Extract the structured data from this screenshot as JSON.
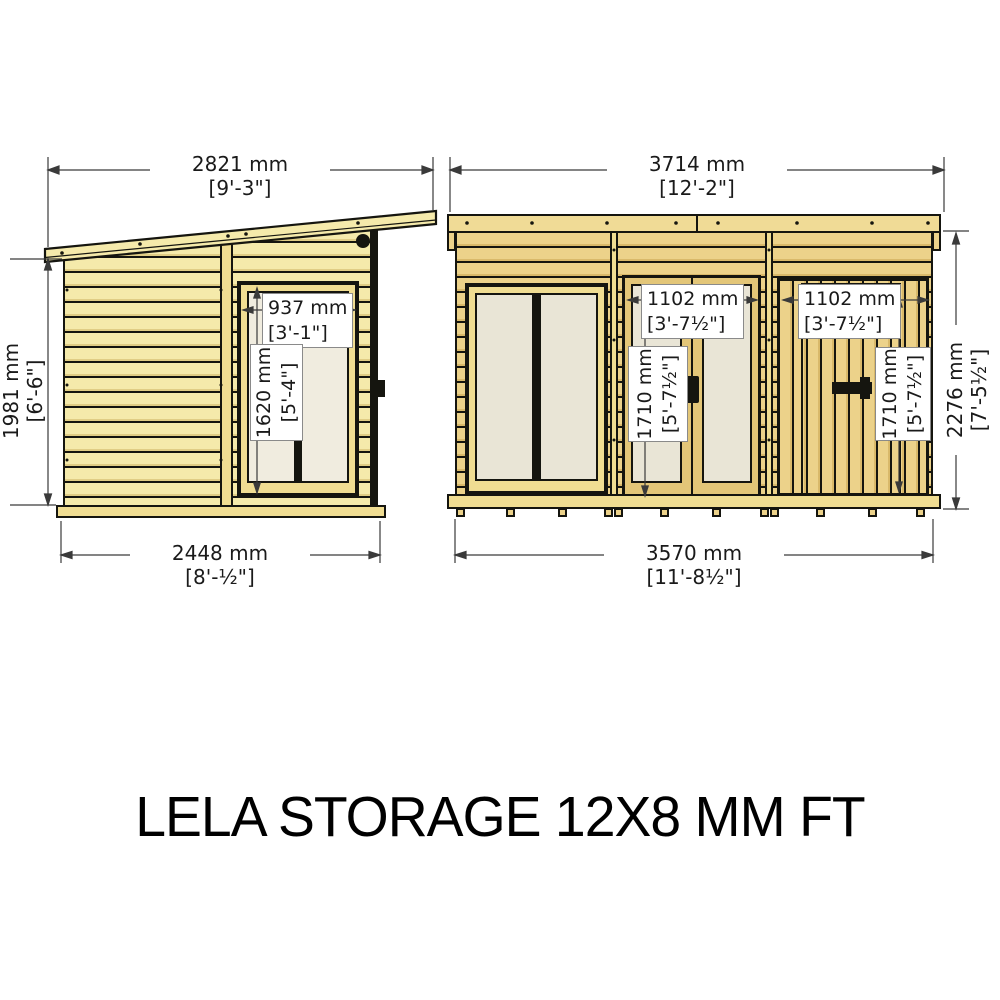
{
  "title": "LELA STORAGE 12X8 MM FT",
  "colors": {
    "outline": "#15150f",
    "wood_pale": "#f5eaab",
    "wood_pale_shade": "#e0cd85",
    "wood_gold": "#ecd28a",
    "wood_gold_shade": "#d9b96a",
    "wood_trim": "#f0dd92",
    "fascia": "#f0db96",
    "glazing": "#e9e5d6",
    "glazing_side": "#f0ecdf",
    "dim_line": "#3a3a3a",
    "label_border": "#8a8a8a",
    "text": "#1a1a1a"
  },
  "side_view": {
    "dims": {
      "roof_width": {
        "mm": "2821 mm",
        "ftin": "[9'-3\"]"
      },
      "height": {
        "mm": "1981 mm",
        "ftin": "[6'-6\"]"
      },
      "base_width": {
        "mm": "2448 mm",
        "ftin": "[8'-½\"]"
      },
      "window_width": {
        "mm": "937 mm",
        "ftin": "[3'-1\"]"
      },
      "window_height": {
        "mm": "1620 mm",
        "ftin": "[5'-4\"]"
      }
    }
  },
  "front_view": {
    "dims": {
      "roof_width": {
        "mm": "3714 mm",
        "ftin": "[12'-2\"]"
      },
      "height": {
        "mm": "2276 mm",
        "ftin": "[7'-5½\"]"
      },
      "base_width": {
        "mm": "3570 mm",
        "ftin": "[11'-8½\"]"
      },
      "door_width": {
        "mm": "1102 mm",
        "ftin": "[3'-7½\"]"
      },
      "door_height": {
        "mm": "1710 mm",
        "ftin": "[5'-7½\"]"
      },
      "store_door_width": {
        "mm": "1102 mm",
        "ftin": "[3'-7½\"]"
      },
      "store_door_height": {
        "mm": "1710 mm",
        "ftin": "[5'-7½\"]"
      }
    }
  }
}
